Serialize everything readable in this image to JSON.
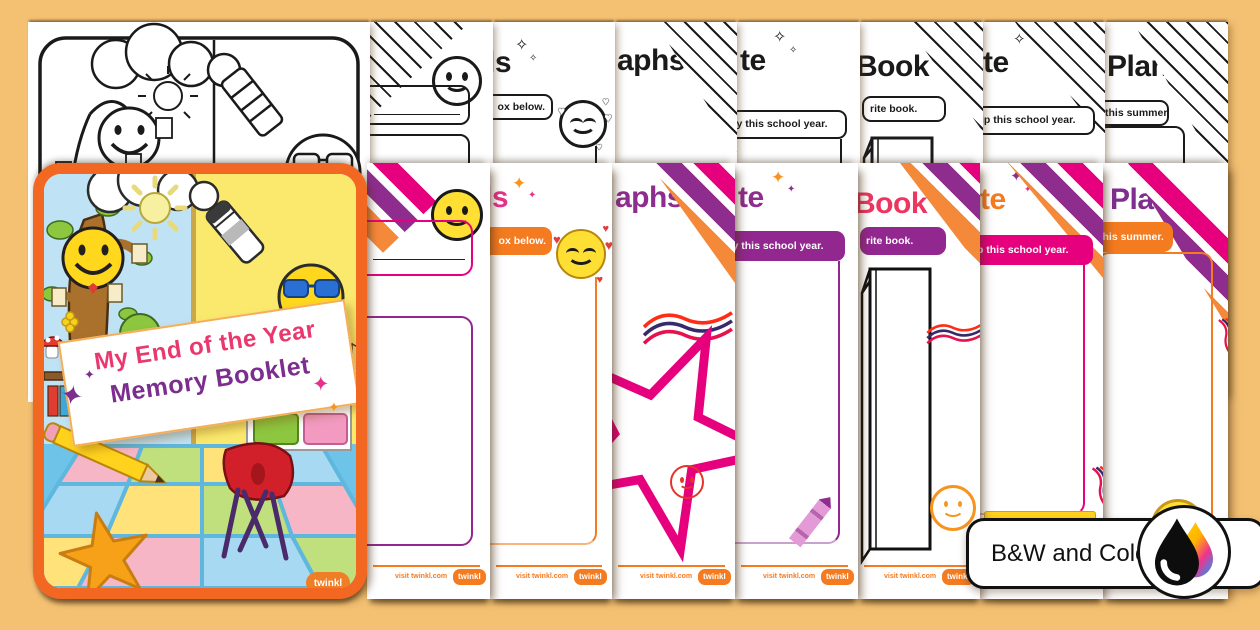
{
  "badge": {
    "label": "B&W and Color"
  },
  "cover": {
    "title_line1": "My End of the Year",
    "title_line2": "Memory Booklet",
    "brand": "twinkl"
  },
  "footer": {
    "visit_text": "visit twinkl.com",
    "brand_label": "twinkl"
  },
  "pages": [
    {
      "name": "cover-page"
    },
    {
      "name": "smiley-page",
      "title_fragment": "",
      "label_fragment": ""
    },
    {
      "name": "goals-page",
      "title_fragment": "ls",
      "label_fragment": "ox below."
    },
    {
      "name": "autographs-page",
      "title_fragment": "aphs",
      "label_fragment": ""
    },
    {
      "name": "favorite-activity-page",
      "title_fragment": "te",
      "label_fragment": "ty this school year."
    },
    {
      "name": "favorite-book-page",
      "title_fragment": "Book",
      "label_fragment": "rite book."
    },
    {
      "name": "favorite-trip-page",
      "title_fragment": "te",
      "label_fragment": "ip this school year."
    },
    {
      "name": "summer-plans-page",
      "title_fragment": "Plans",
      "label_fragment": "this summer."
    }
  ],
  "palette": {
    "background": "#f4c173",
    "orange": "#f47b20",
    "pink": "#e6007e",
    "magenta": "#e6318a",
    "purple": "#8e2d8e",
    "title_book_pink": "#ee3560",
    "yellow": "#ffd71c",
    "red": "#ed3b2f",
    "black": "#1a1a1a"
  }
}
